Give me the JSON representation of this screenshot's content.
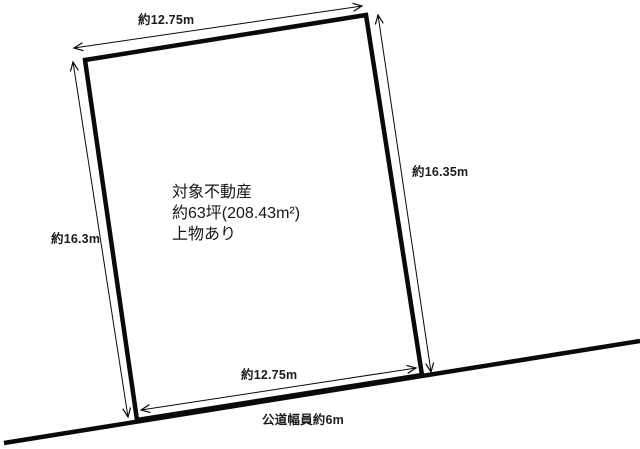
{
  "page": {
    "background_color": "#ffffff",
    "line_color": "#0a0a0a"
  },
  "parcel": {
    "description": {
      "line1": "対象不動産",
      "line2": "約63坪(208.43m²)",
      "line3": "上物あり"
    },
    "dimensions": {
      "top": "約12.75m",
      "left": "約16.3m",
      "right": "約16.35m",
      "bottom": "約12.75m"
    },
    "road": {
      "label": "公道幅員約6m"
    }
  }
}
